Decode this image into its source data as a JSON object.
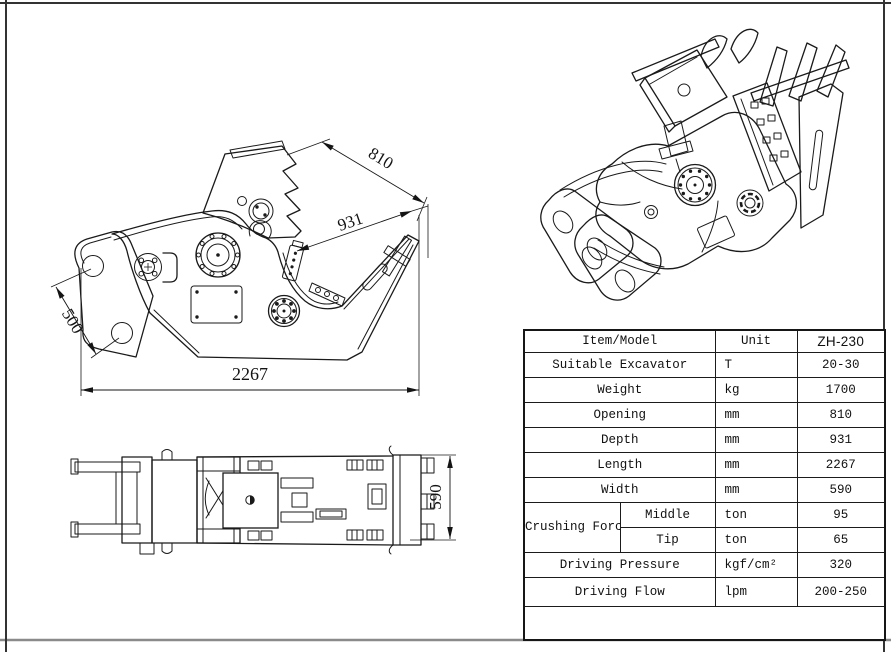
{
  "sheet": {
    "background": "#ffffff",
    "line_color": "#1a1a1a",
    "frame_color": "#333333"
  },
  "views": {
    "side": {
      "dims": {
        "opening": "810",
        "depth": "931",
        "bracket": "500",
        "length": "2267"
      }
    },
    "plan": {
      "dims": {
        "width": "590"
      }
    }
  },
  "table": {
    "header": {
      "item": "Item/Model",
      "unit": "Unit",
      "model": "ZH-230"
    },
    "rows": [
      {
        "item": "Suitable Excavator",
        "unit": "T",
        "value": "20-30"
      },
      {
        "item": "Weight",
        "unit": "kg",
        "value": "1700"
      },
      {
        "item": "Opening",
        "unit": "mm",
        "value": "810"
      },
      {
        "item": "Depth",
        "unit": "mm",
        "value": "931"
      },
      {
        "item": "Length",
        "unit": "mm",
        "value": "2267"
      },
      {
        "item": "Width",
        "unit": "mm",
        "value": "590"
      },
      {
        "item": "Crushing Force",
        "sub": "Middle",
        "unit": "ton",
        "value": "95"
      },
      {
        "item": "Crushing Force",
        "sub": "Tip",
        "unit": "ton",
        "value": "65"
      },
      {
        "item": "Driving Pressure",
        "unit": "kgf/cm²",
        "value": "320"
      },
      {
        "item": "Driving Flow",
        "unit": "lpm",
        "value": "200-250"
      }
    ]
  }
}
